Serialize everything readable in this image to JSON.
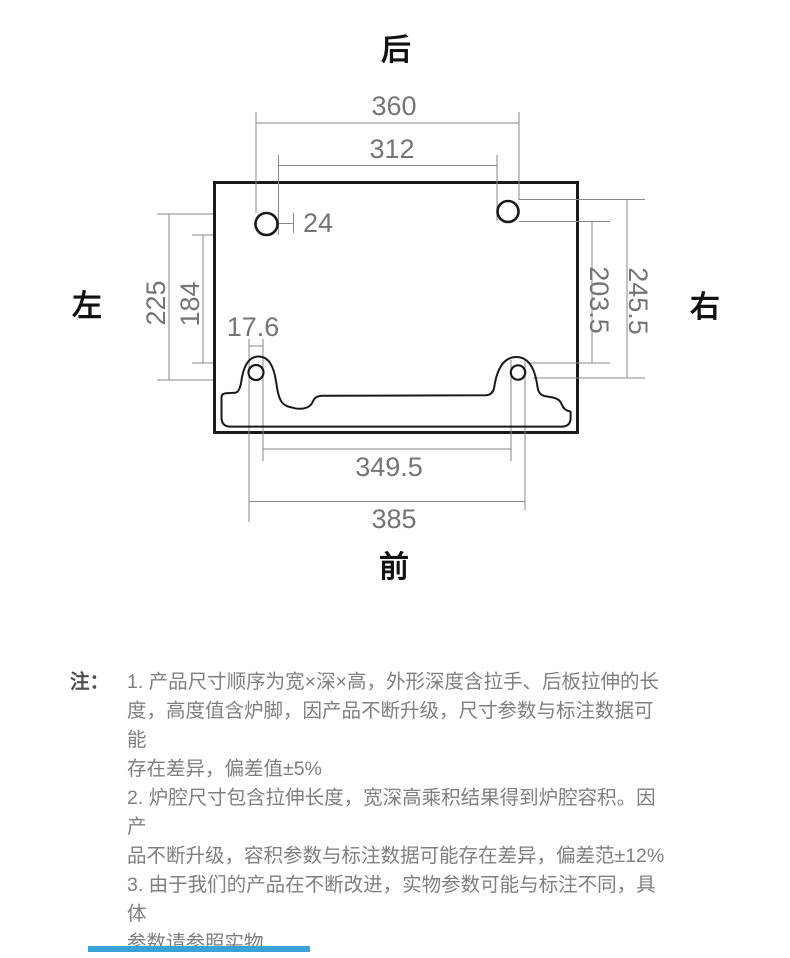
{
  "diagram": {
    "orientation_labels": {
      "back": "后",
      "front": "前",
      "left": "左",
      "right": "右"
    },
    "dimensions": {
      "top_span_outer": "360",
      "top_span_inner": "312",
      "top_hole_diameter": "24",
      "left_span_outer": "225",
      "left_span_inner": "184",
      "right_span_inner": "203.5",
      "right_span_outer": "245.5",
      "front_hole_diameter": "17.6",
      "bottom_span_inner": "349.5",
      "bottom_span_outer": "385"
    }
  },
  "notes": {
    "label": "注：",
    "lines": [
      "1. 产品尺寸顺序为宽×深×高，外形深度含拉手、后板拉伸的长",
      "度，高度值含炉脚，因产品不断升级，尺寸参数与标注数据可能",
      "存在差异，偏差值±5%",
      "2. 炉腔尺寸包含拉伸长度，宽深高乘积结果得到炉腔容积。因产",
      "品不断升级，容积参数与标注数据可能存在差异，偏差范±12%",
      "3. 由于我们的产品在不断改进，实物参数可能与标注不同，具体",
      "参数请参照实物"
    ]
  },
  "colors": {
    "dim_line": "#8a8a8a",
    "dim_text": "#757575",
    "shape_outline": "#1a1a1a",
    "notes_text": "#7f7f7f",
    "next_section_blue": "#3aa2d9"
  }
}
